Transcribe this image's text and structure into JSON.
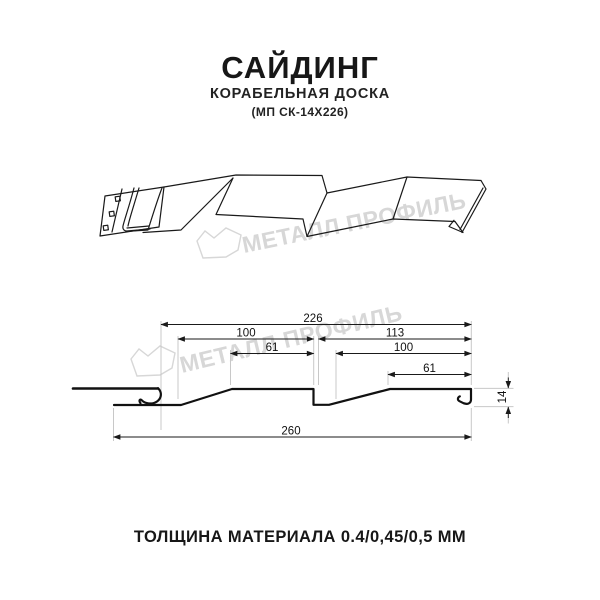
{
  "header": {
    "title": "САЙДИНГ",
    "subtitle": "КОРАБЕЛЬНАЯ ДОСКА",
    "model": "(МП СК-14Х226)"
  },
  "watermark": {
    "text": "МЕТАЛЛ ПРОФИЛЬ"
  },
  "section": {
    "dims": {
      "width_total": "226",
      "left_panel": "100",
      "right_panel": "113",
      "left_flat": "61",
      "right_flat_100": "100",
      "right_flat_61": "61",
      "height": "14",
      "overall": "260"
    }
  },
  "footer": {
    "thickness": "ТОЛЩИНА МАТЕРИАЛА 0.4/0,45/0,5 ММ"
  },
  "colors": {
    "line": "#1a1a1a",
    "extension": "#c8c8c8",
    "watermark": "#d7d7d7",
    "background": "#ffffff"
  }
}
